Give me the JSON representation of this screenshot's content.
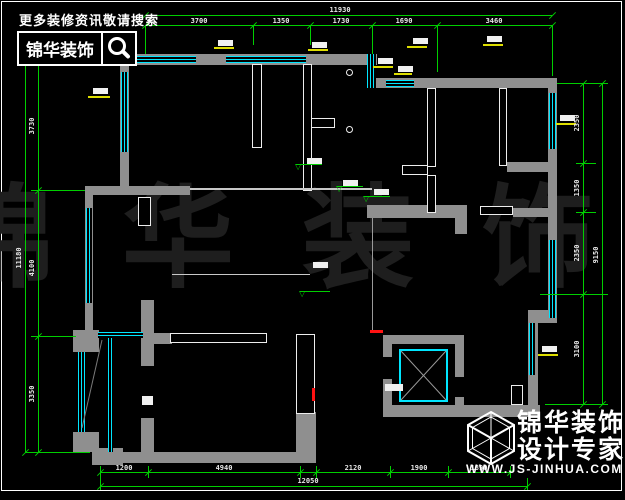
{
  "brand": {
    "tagline": "更多装修资讯敬请搜索",
    "name": "锦华装饰",
    "watermark": "锦华装饰",
    "footer1": "锦华装饰",
    "footer2": "设计专家",
    "site": "WWW.JS-JINHUA.COM"
  },
  "dims": {
    "top": {
      "overall": "11930",
      "segments": [
        "3700",
        "1350",
        "1730",
        "1690",
        "3460"
      ]
    },
    "left": {
      "overall": "11180",
      "segments": [
        "3730",
        "4100",
        "3350"
      ]
    },
    "right": {
      "overall": "9150",
      "segments": [
        "2350",
        "1350",
        "2350",
        "3100"
      ]
    },
    "bottom": {
      "overall": "12050",
      "segments": [
        "1200",
        "4940",
        "2120",
        "1900",
        "1890"
      ]
    }
  },
  "colors": {
    "background": "#000000",
    "dimension_green": "#00cf00",
    "window_cyan": "#00e6ff",
    "wall_gray": "#8f8f8f",
    "accent_red": "#ff1212",
    "label_yellow": "#dede00",
    "watermark_gray": "#1e1e1e"
  }
}
